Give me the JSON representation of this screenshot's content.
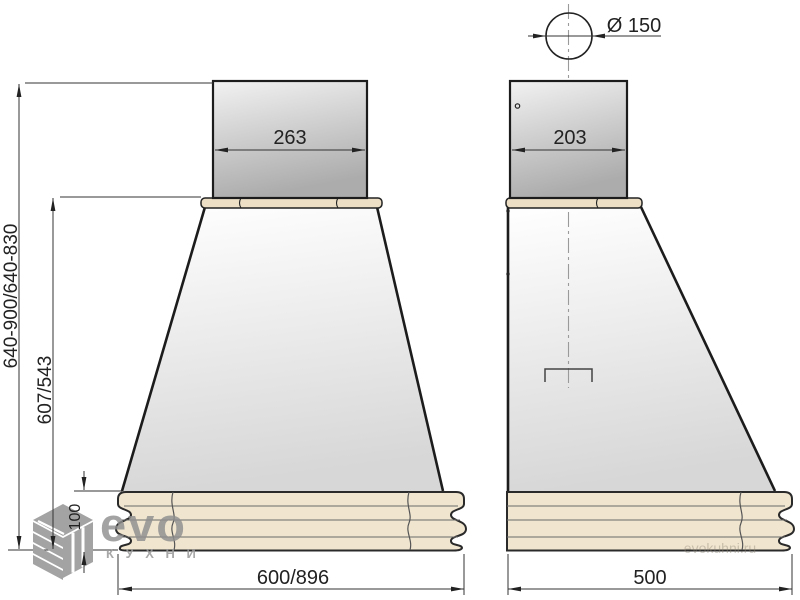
{
  "drawing": {
    "subject": "kitchen hood technical drawing, front and side views"
  },
  "dimensions": {
    "duct_diameter": "Ø 150",
    "flue_front_width": "263",
    "flue_side_depth": "203",
    "overall_height_range": "640-900/640-830",
    "body_height": "607/543",
    "cornice_height": "100",
    "overall_width": "600/896",
    "overall_depth": "500"
  },
  "branding": {
    "logo_main": "evo",
    "logo_sub": "К У Х Н И",
    "site_watermark": "evokuhni.ru"
  },
  "colors": {
    "outline": "#1c1c1c",
    "dimension_line": "#333333",
    "cornice_fill": "#f0e5cf",
    "strip_fill": "#ecdfc6",
    "metal_light": "#f1f1f1",
    "metal_dark": "#adadad",
    "canopy_light": "#ffffff",
    "canopy_dark": "#d9d9d9",
    "centerline_gray": "#999999",
    "logo_gray": "#8f8f8f"
  }
}
